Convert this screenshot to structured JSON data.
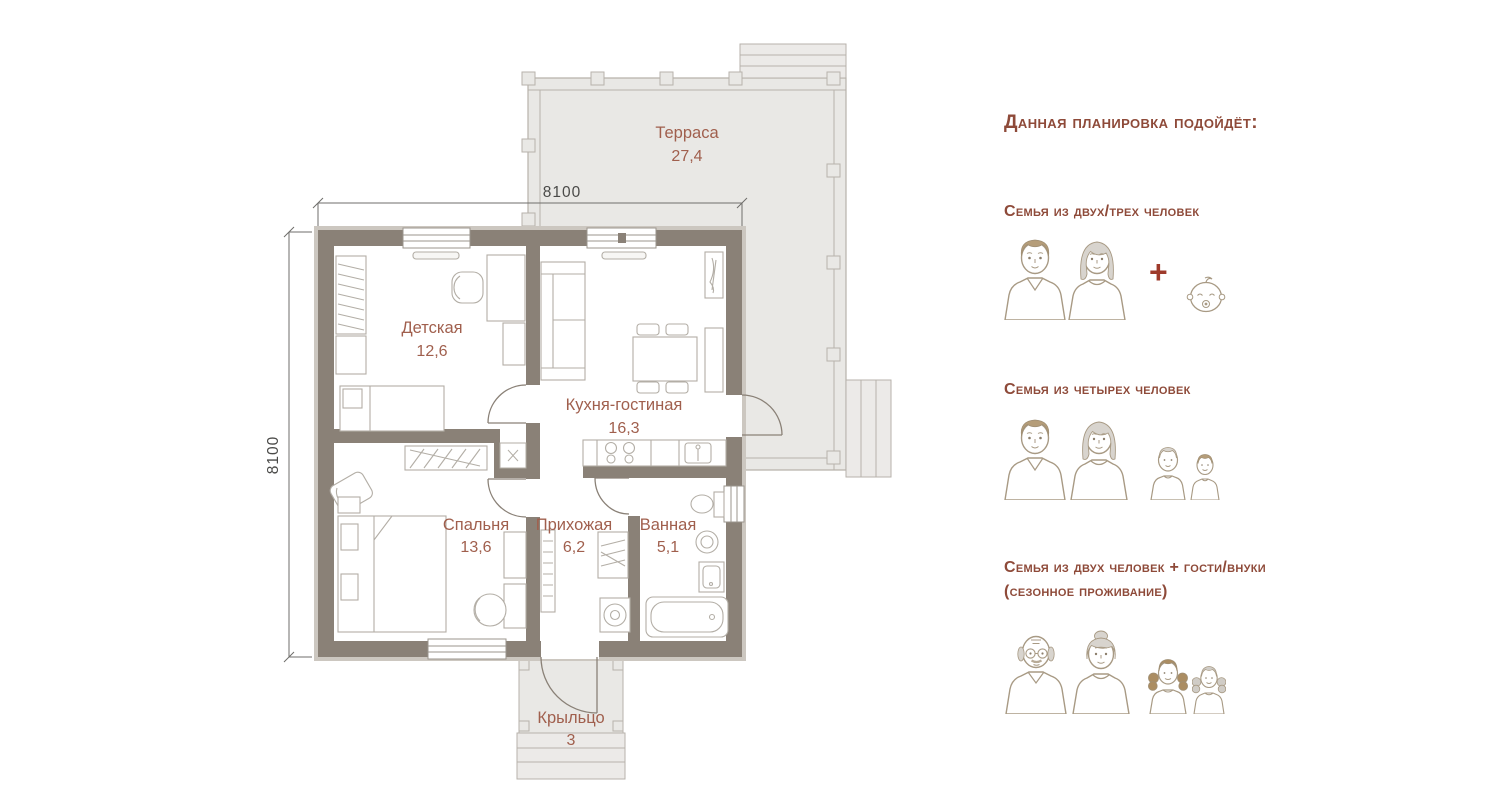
{
  "plan": {
    "dimension_width": "8100",
    "dimension_depth": "8100",
    "rooms": [
      {
        "name": "Терраса",
        "area": "27,4"
      },
      {
        "name": "Детская",
        "area": "12,6"
      },
      {
        "name": "Кухня-гостиная",
        "area": "16,3"
      },
      {
        "name": "Спальня",
        "area": "13,6"
      },
      {
        "name": "Прихожая",
        "area": "6,2"
      },
      {
        "name": "Ванная",
        "area": "5,1"
      },
      {
        "name": "Крыльцо",
        "area": "3"
      }
    ]
  },
  "panel": {
    "title": "Данная планировка подойдёт:",
    "options": [
      {
        "label": "Семья из двух/трех человек",
        "plus": "+"
      },
      {
        "label": "Семья из четырех человек"
      },
      {
        "label": "Семья из двух человек + гости/внуки",
        "label2": "(сезонное проживание)"
      }
    ]
  },
  "colors": {
    "heading": "#8e4a39",
    "room_label": "#a05f4d",
    "wall": "#8a8177",
    "terrace_fill": "#e9e8e5",
    "outline": "#b7b2ab",
    "hair_tan": "#b59d79",
    "hair_gray": "#d8d4ce",
    "plus_sign": "#9e3a2b",
    "dimension_text": "#4a4a48"
  }
}
